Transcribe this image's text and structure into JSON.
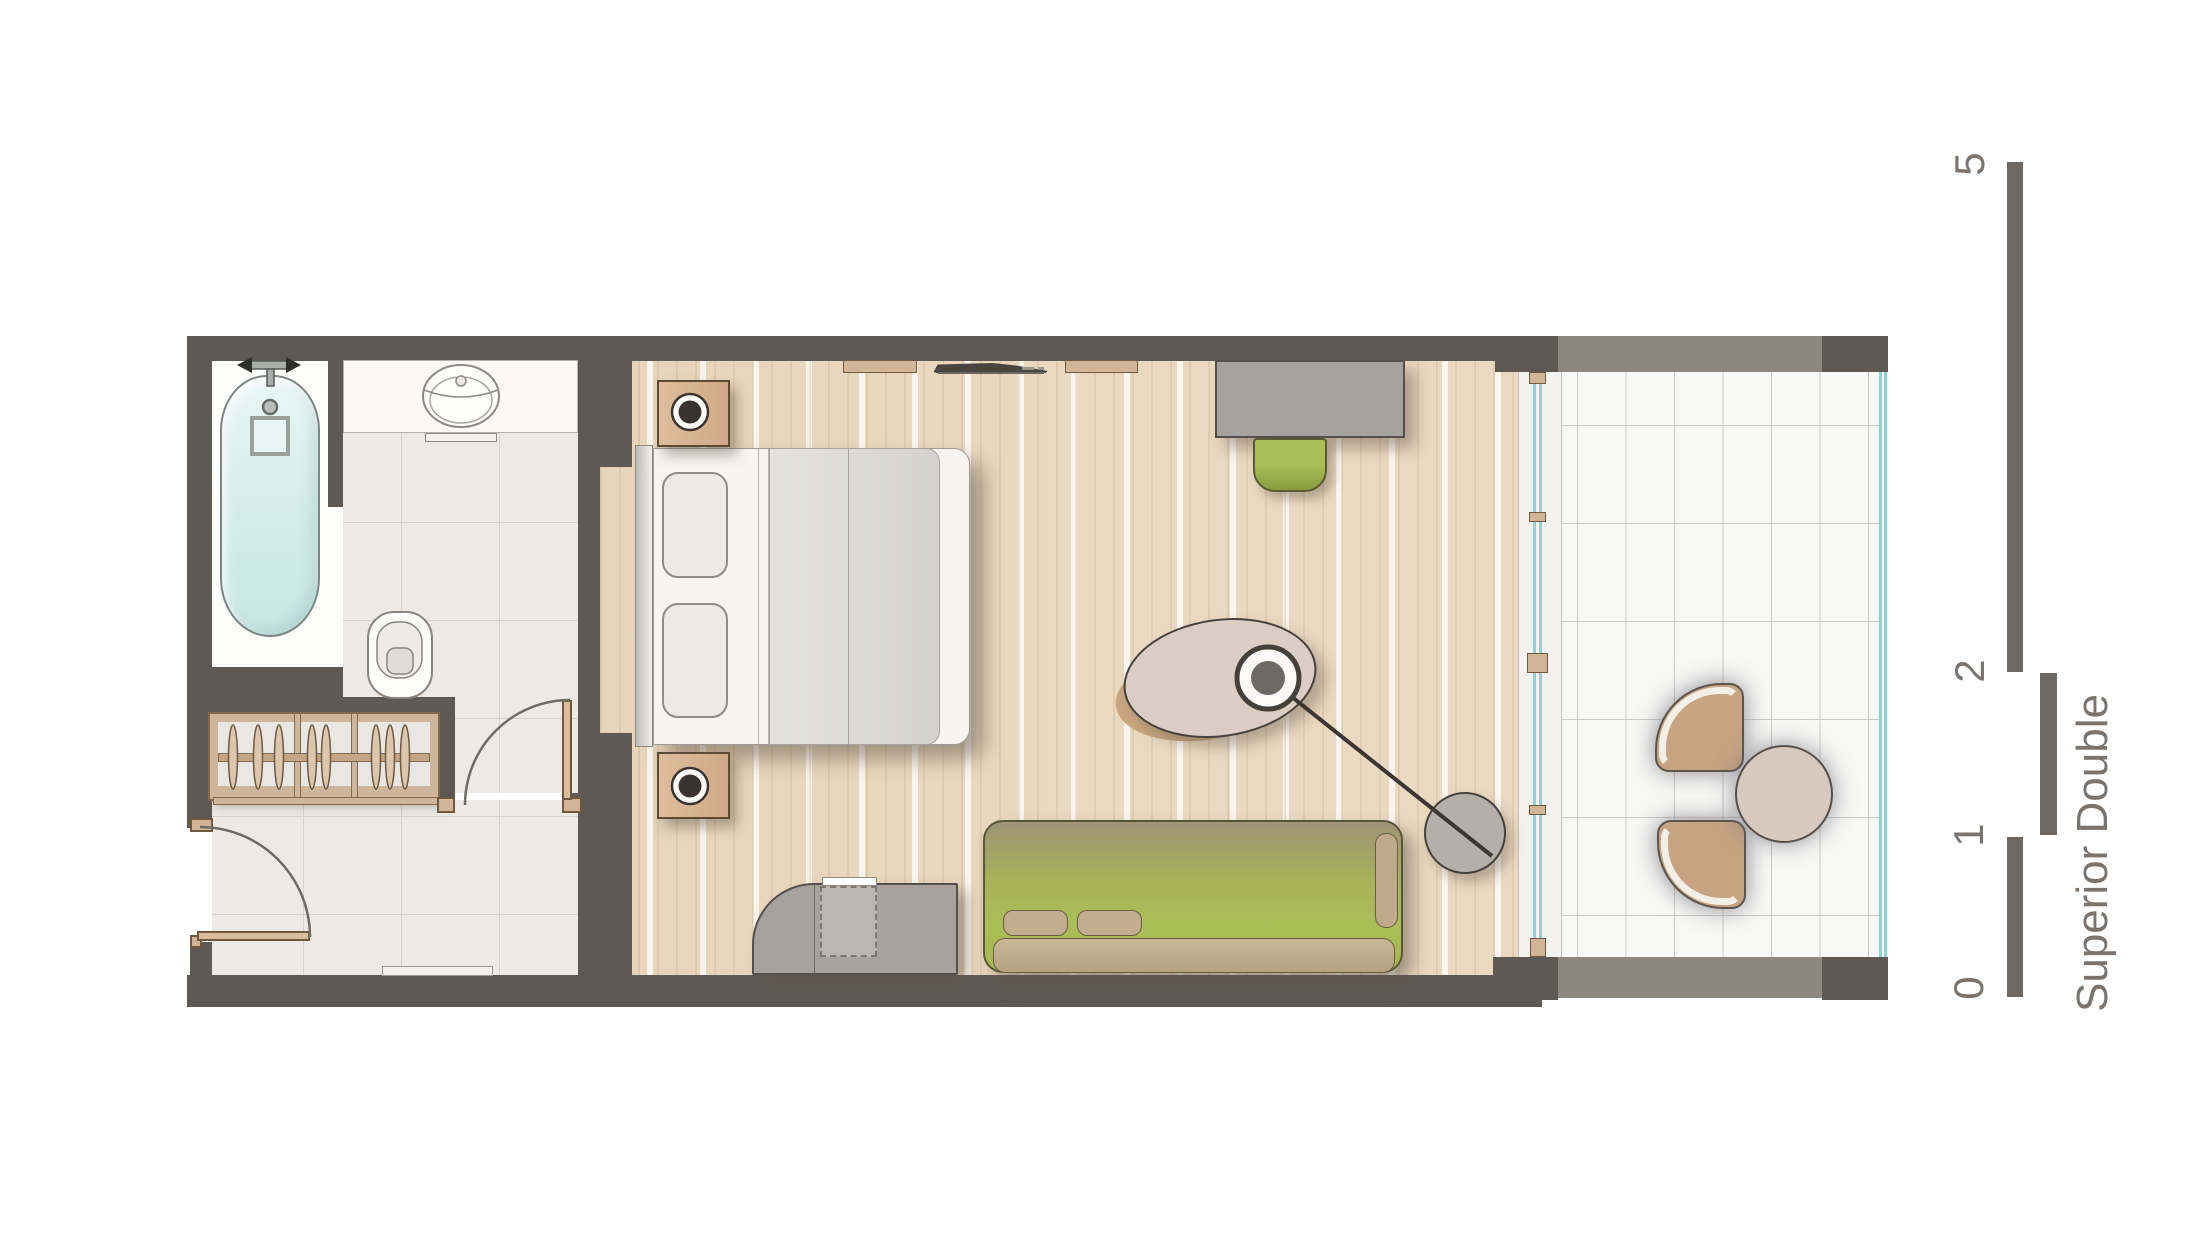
{
  "title": "Superior Double",
  "scale_bar": {
    "orientation": "vertical",
    "labels": [
      "0",
      "1",
      "2",
      "5"
    ],
    "bar_color": "#6e6862",
    "text_color": "#7b746e"
  },
  "colors": {
    "wall": "#5f5954",
    "balcony_wall": "#8e8780",
    "wood_floor": "#ead9c1",
    "tile_floor": "#edeae5",
    "balcony_tile": "#f8f8f6",
    "sofa_green": "#a9bc55",
    "furniture_tan": "#d2b496",
    "furniture_gray": "#a7a29d",
    "window_glass": "#8fd4d4",
    "bathtub": "#d9f0ee"
  },
  "rooms": [
    "bathroom",
    "entry-corridor",
    "bedroom",
    "balcony"
  ],
  "furniture": [
    "bathtub",
    "shower-fixture",
    "basin-counter",
    "washbasin",
    "towel-rail",
    "toilet",
    "wardrobe-with-hangers",
    "entry-door",
    "bathroom-door",
    "double-bed",
    "pillow",
    "duvet",
    "nightstand-with-lamp",
    "wall-shelf",
    "wall-tv",
    "desk",
    "desk-chair",
    "tv-sideboard",
    "green-chair",
    "sofa",
    "oval-coffee-table",
    "arc-floor-lamp",
    "window-wall",
    "balcony-chair",
    "balcony-round-table",
    "balcony-glass-railing",
    "door-threshold"
  ]
}
